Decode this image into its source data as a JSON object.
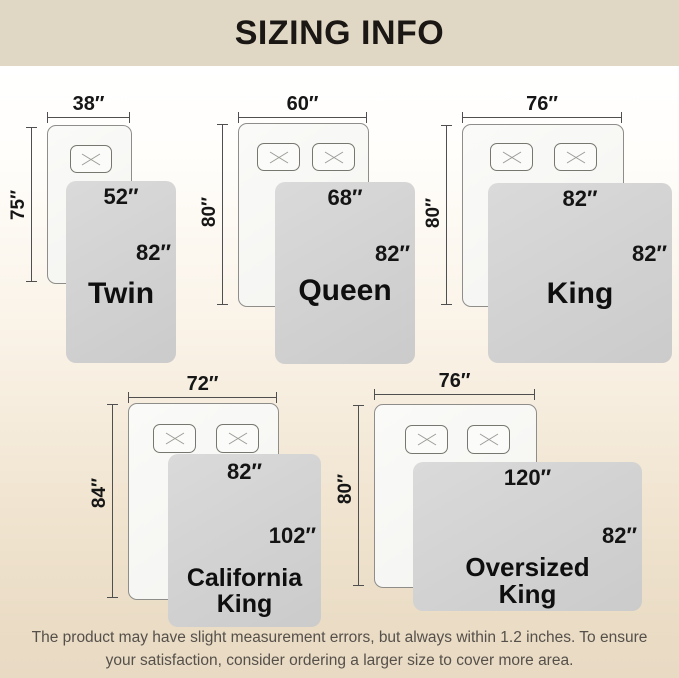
{
  "title": "SIZING INFO",
  "sizes": [
    {
      "name": "Twin",
      "bed_width": "38″",
      "bed_height": "75″",
      "blanket_width": "52″",
      "blanket_height": "82″",
      "pillows": 1
    },
    {
      "name": "Queen",
      "bed_width": "60″",
      "bed_height": "80″",
      "blanket_width": "68″",
      "blanket_height": "82″",
      "pillows": 2
    },
    {
      "name": "King",
      "bed_width": "76″",
      "bed_height": "80″",
      "blanket_width": "82″",
      "blanket_height": "82″",
      "pillows": 2
    },
    {
      "name": "California King",
      "bed_width": "72″",
      "bed_height": "84″",
      "blanket_width": "82″",
      "blanket_height": "102″",
      "pillows": 2
    },
    {
      "name": "Oversized King",
      "bed_width": "76″",
      "bed_height": "80″",
      "blanket_width": "120″",
      "blanket_height": "82″",
      "pillows": 2
    }
  ],
  "footer": {
    "text": "The product may have slight measurement errors, but always within 1.2 inches. To ensure your satisfaction, consider ordering a larger size to cover more area."
  },
  "colors": {
    "header_bg": "#e1d7c5",
    "background_bottom": "#e8dac3",
    "blanket": "#d3d3d3",
    "bed_fill": "#f8f8f6",
    "bed_border": "#8e8d8a",
    "dimension_line": "#4f4f4f",
    "label_text": "#141414",
    "footer_text": "#55504a"
  }
}
